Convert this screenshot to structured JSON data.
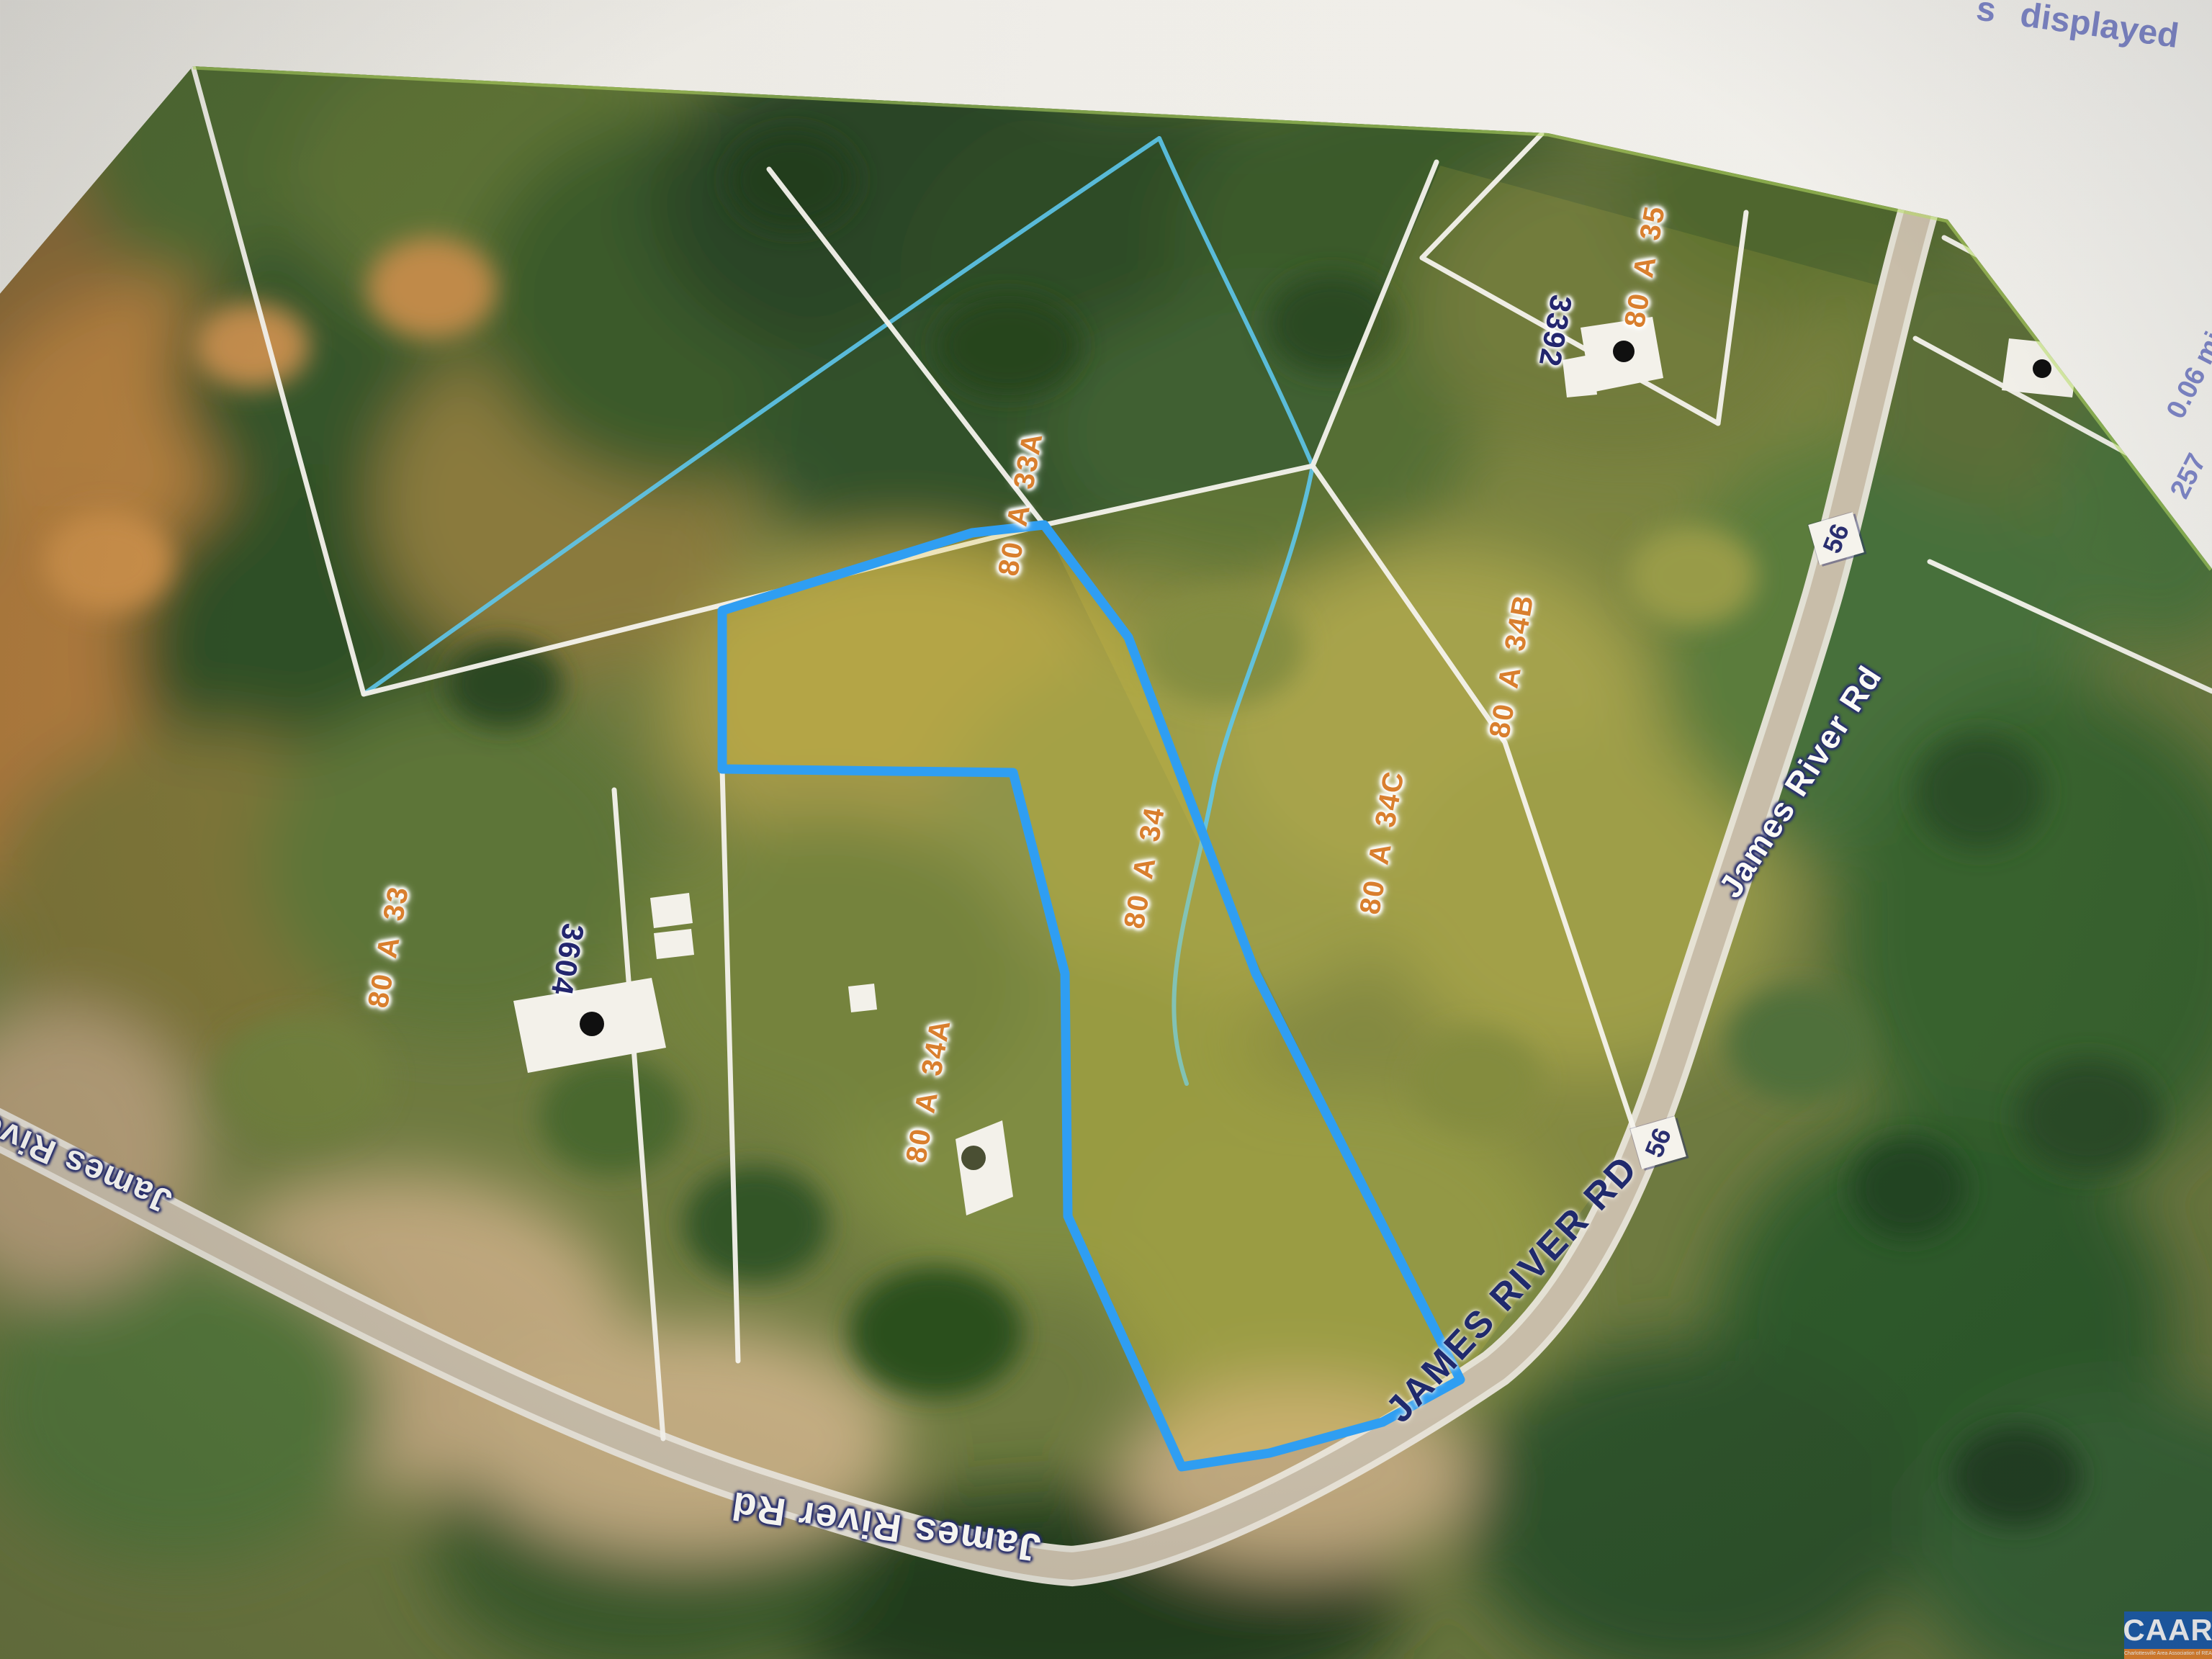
{
  "paper": {
    "fragment": "s",
    "note": "displayed",
    "scale_mi": "0.06 mi",
    "scale_num": "257"
  },
  "map": {
    "parcels": {
      "p33a": "80 A 33A",
      "p34": "80 A 34",
      "p34a": "80 A 34A",
      "p34b": "80 A 34B",
      "p34c": "80 A 34C",
      "p35": "80 A 35",
      "p33": "80 A 33"
    },
    "houses": {
      "h3392": "3392",
      "h3604": "3604"
    },
    "roads": {
      "top": "James River Rd",
      "mid": "JAMES RIVER RD",
      "bottom": "James River Rd",
      "left": "James Rive"
    },
    "route": {
      "shield1": "56",
      "shield2": "56"
    }
  },
  "colors": {
    "highlight_blue": "#2f9ef2",
    "parcel_label_orange": "#d97f2e",
    "house_number_navy": "#23266e",
    "road_label_navy": "#202a6d",
    "paper_text_blue": "#7d85c5",
    "caar_blue": "#1d5fae",
    "caar_orange": "#e8862d"
  },
  "watermark": {
    "logo": "CAAR",
    "tagline": "Charlottesville Area Association of REALTORS®"
  }
}
